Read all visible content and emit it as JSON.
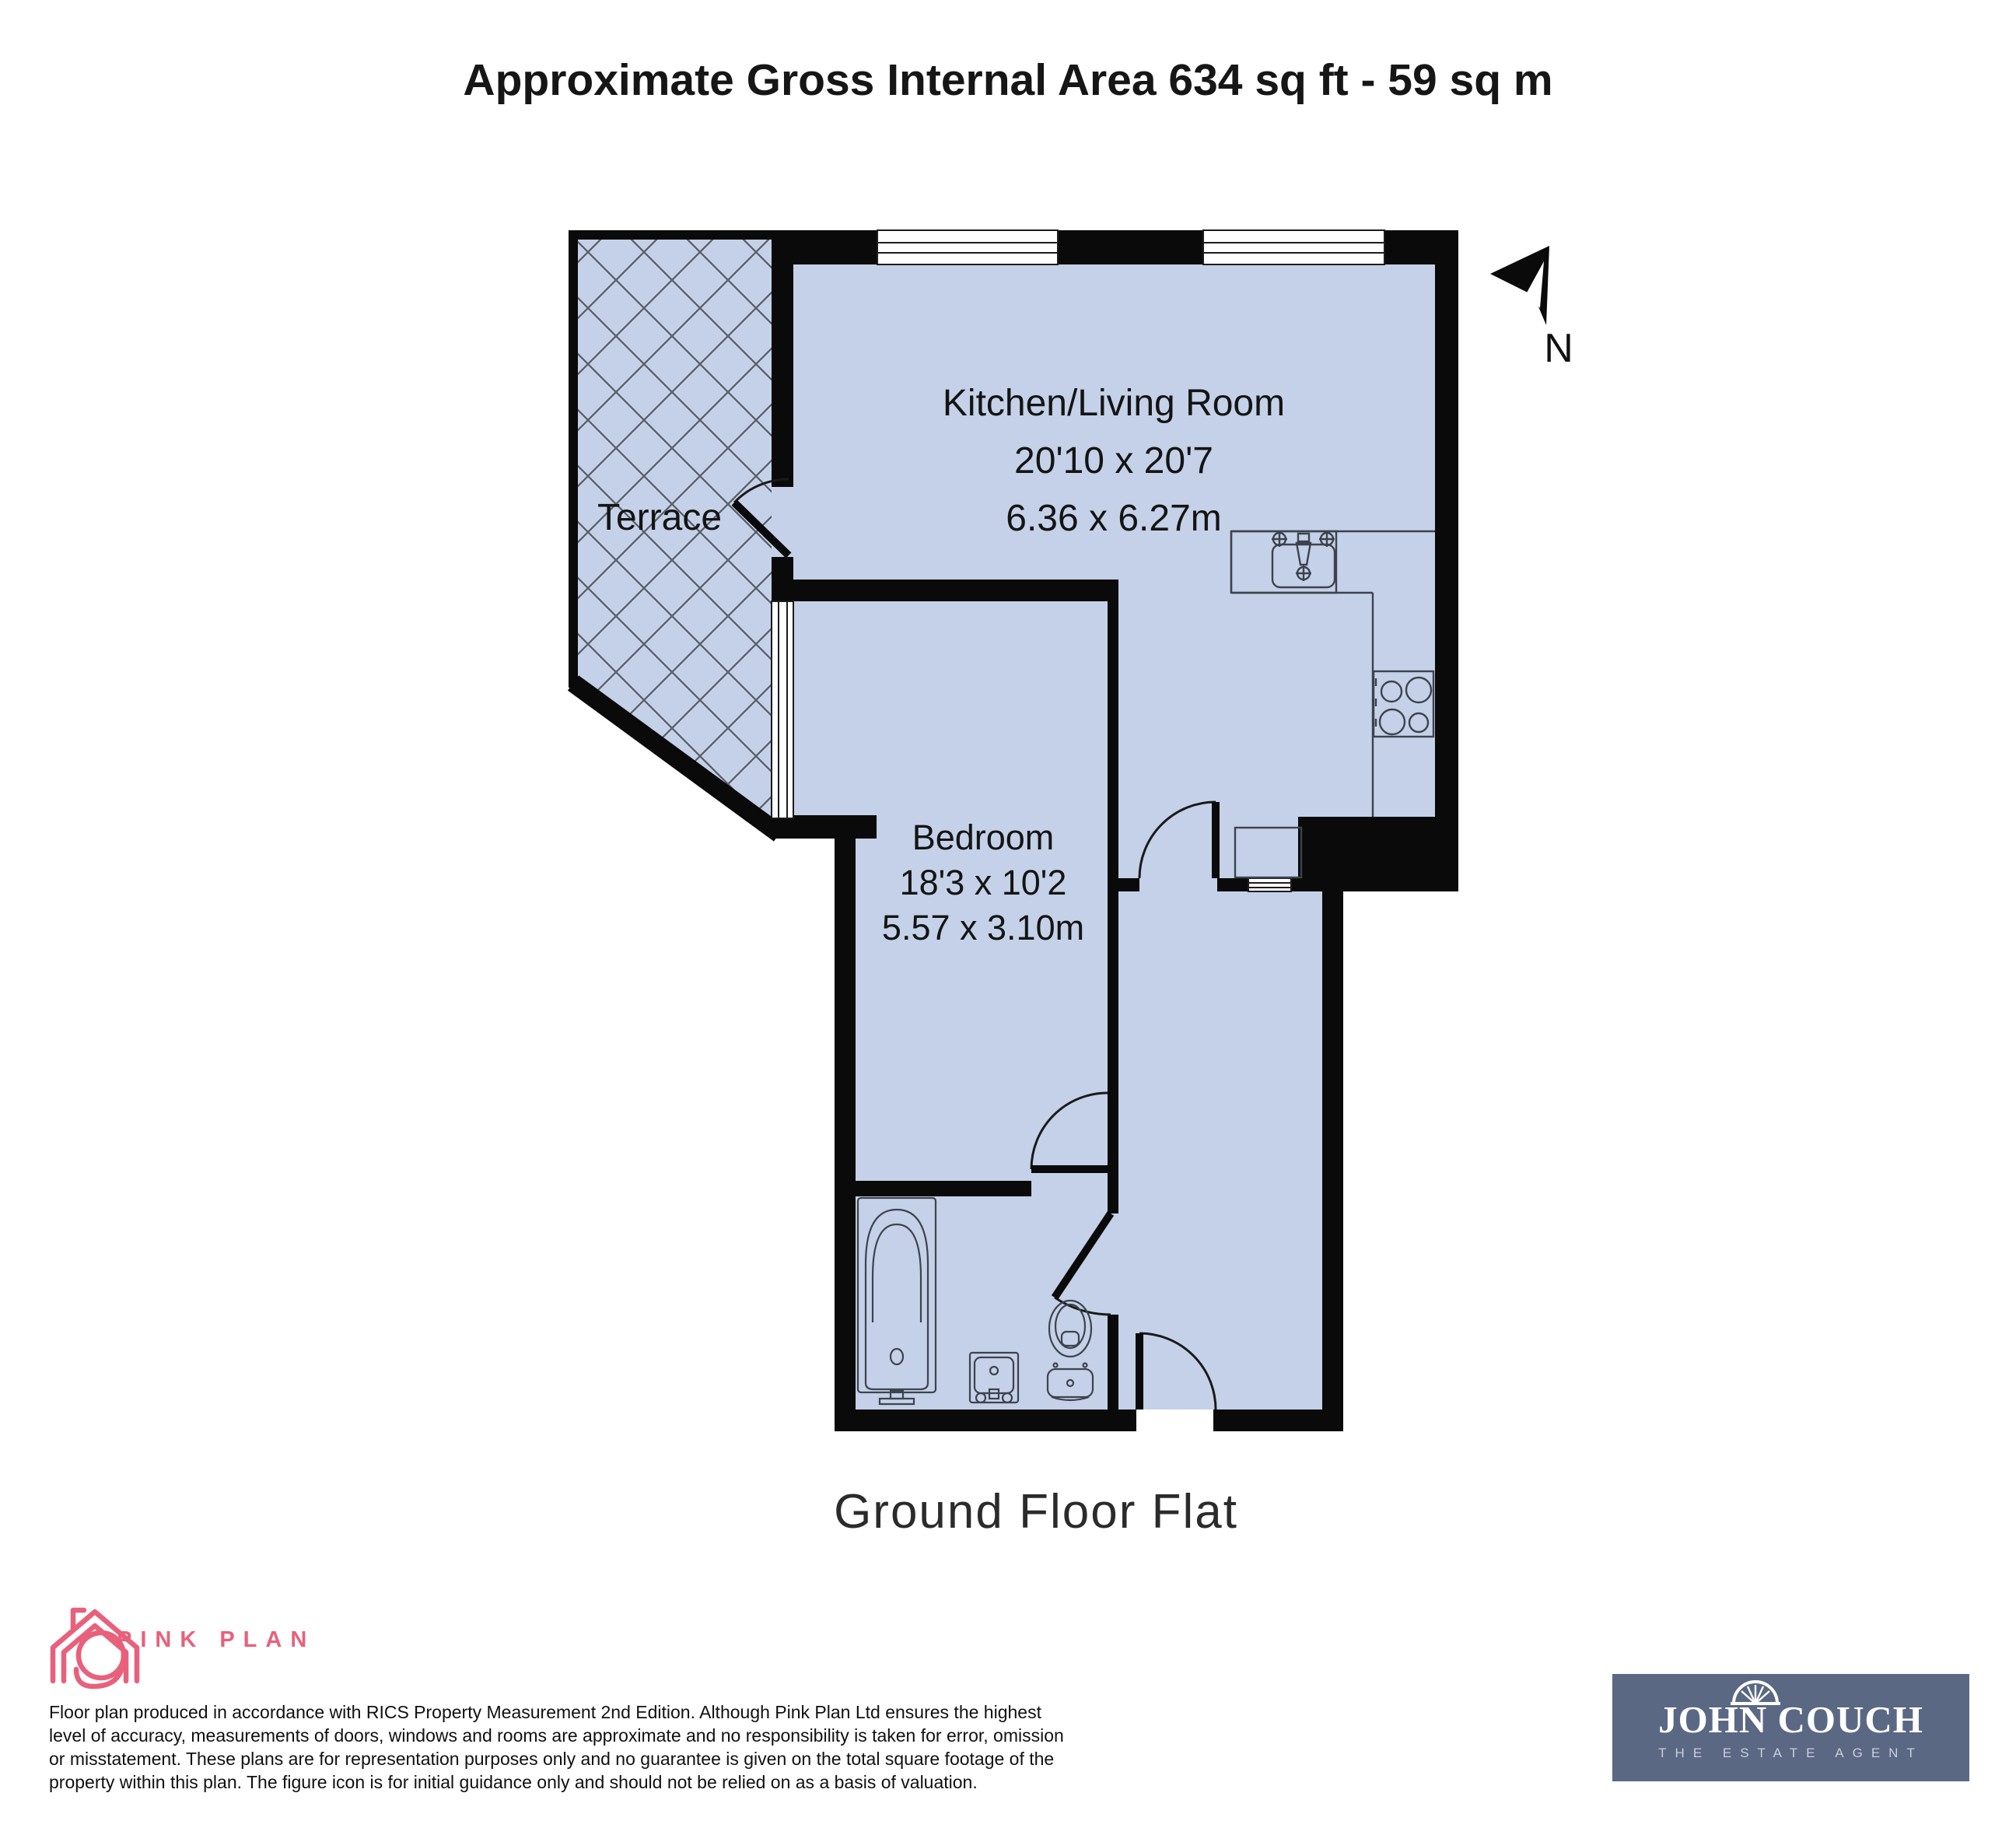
{
  "title": "Approximate Gross Internal Area 634 sq ft - 59 sq m",
  "plan": {
    "floor_label": "Ground Floor Flat",
    "compass_label": "N",
    "rooms": {
      "terrace": {
        "name": "Terrace"
      },
      "kitchen_living_room": {
        "name": "Kitchen/Living Room",
        "size_imperial": "20'10 x 20'7",
        "size_metric": "6.36 x 6.27m"
      },
      "bedroom": {
        "name": "Bedroom",
        "size_imperial": "18'3 x 10'2",
        "size_metric": "5.57 x 3.10m"
      }
    },
    "colors": {
      "floor_fill": "#c4d1e8",
      "wall": "#0a0a0a",
      "hatch_line": "#565b64",
      "fixture_line": "#3d434d"
    }
  },
  "footer": {
    "pink_plan": {
      "brand": "PINK PLAN",
      "color": "#e8617c"
    },
    "disclaimer_lines": [
      "Floor plan produced in accordance with RICS Property Measurement 2nd Edition. Although Pink Plan Ltd ensures the highest",
      "level of accuracy, measurements of doors, windows and rooms are approximate and no responsibility is taken for error, omission",
      "or misstatement. These plans are for representation purposes only and no guarantee is given on the total square footage of the",
      "property within this plan. The figure icon is for initial guidance only and should not be relied on as a basis of valuation."
    ],
    "agent_logo": {
      "name": "JOHN COUCH",
      "tagline": "THE ESTATE AGENT",
      "bg_color": "#5a6884"
    }
  }
}
